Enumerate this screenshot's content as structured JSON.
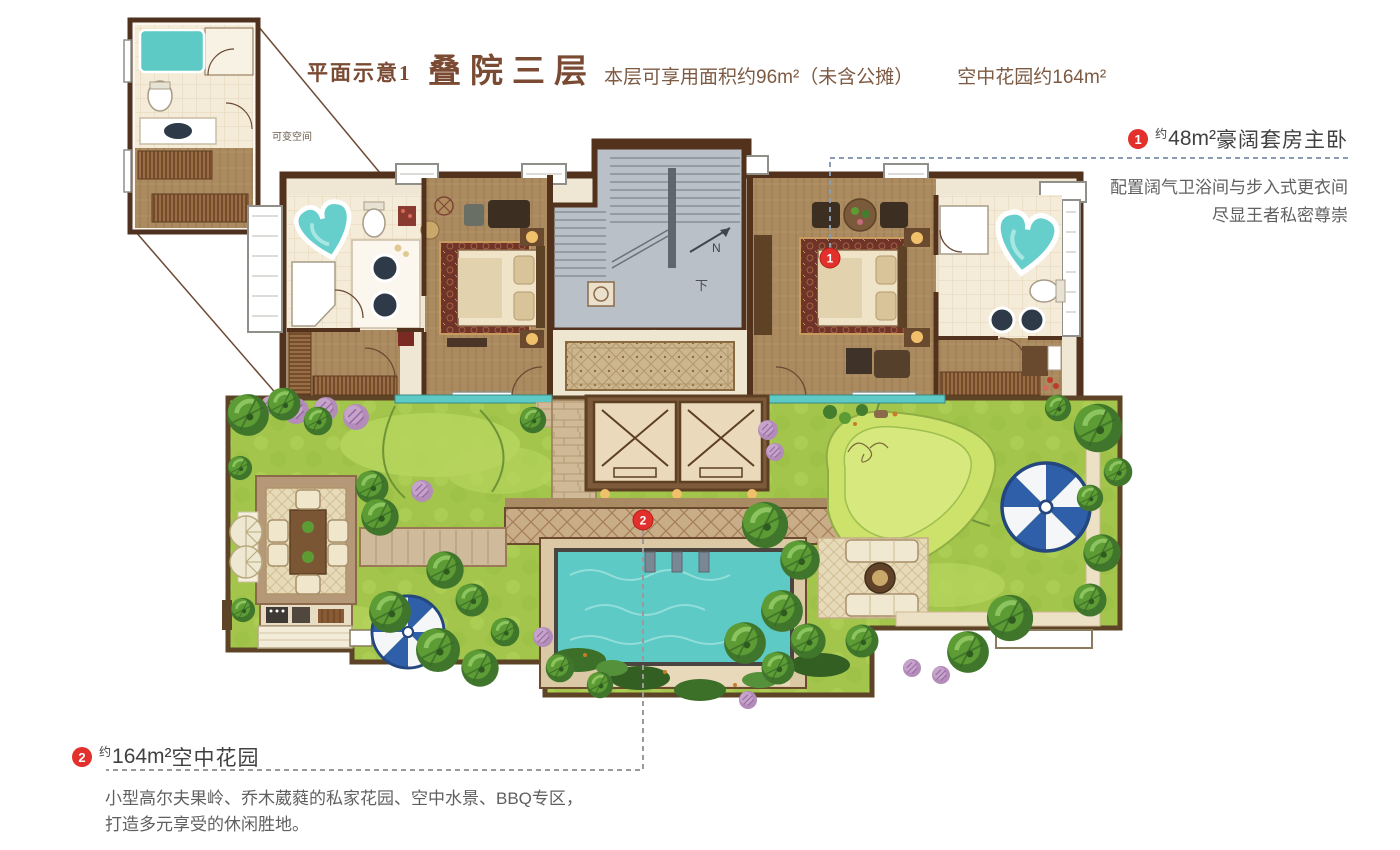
{
  "header": {
    "label": "平面示意1",
    "title": "叠院三层",
    "area_note": "本层可享用面积约96m²（未含公摊）",
    "garden_note": "空中花园约164m²"
  },
  "inset": {
    "label": "可变空间"
  },
  "plan": {
    "stair_down_label": "下",
    "north_label": "N"
  },
  "annotation1": {
    "marker": "1",
    "approx": "约",
    "area": "48m²",
    "title": "豪阔套房主卧",
    "desc1": "配置阔气卫浴间与步入式更衣间",
    "desc2": "尽显王者私密尊崇"
  },
  "annotation2": {
    "marker": "2",
    "approx": "约",
    "area": "164m²",
    "title": "空中花园",
    "desc1": "小型高尔夫果岭、乔木葳蕤的私家花园、空中水景、BBQ专区，",
    "desc2": "打造多元享受的休闲胜地。"
  },
  "colors": {
    "accent_red": "#e2302c",
    "title_brown": "#7a4a33",
    "text_gray": "#606060",
    "wall_brown": "#53321d",
    "wood_floor": "#ab8a5f",
    "tile_cream": "#f4ebd9",
    "water_teal": "#5ecac6",
    "lawn_green": "#a3c54b",
    "umbrella_blue": "#2f5fa8"
  }
}
